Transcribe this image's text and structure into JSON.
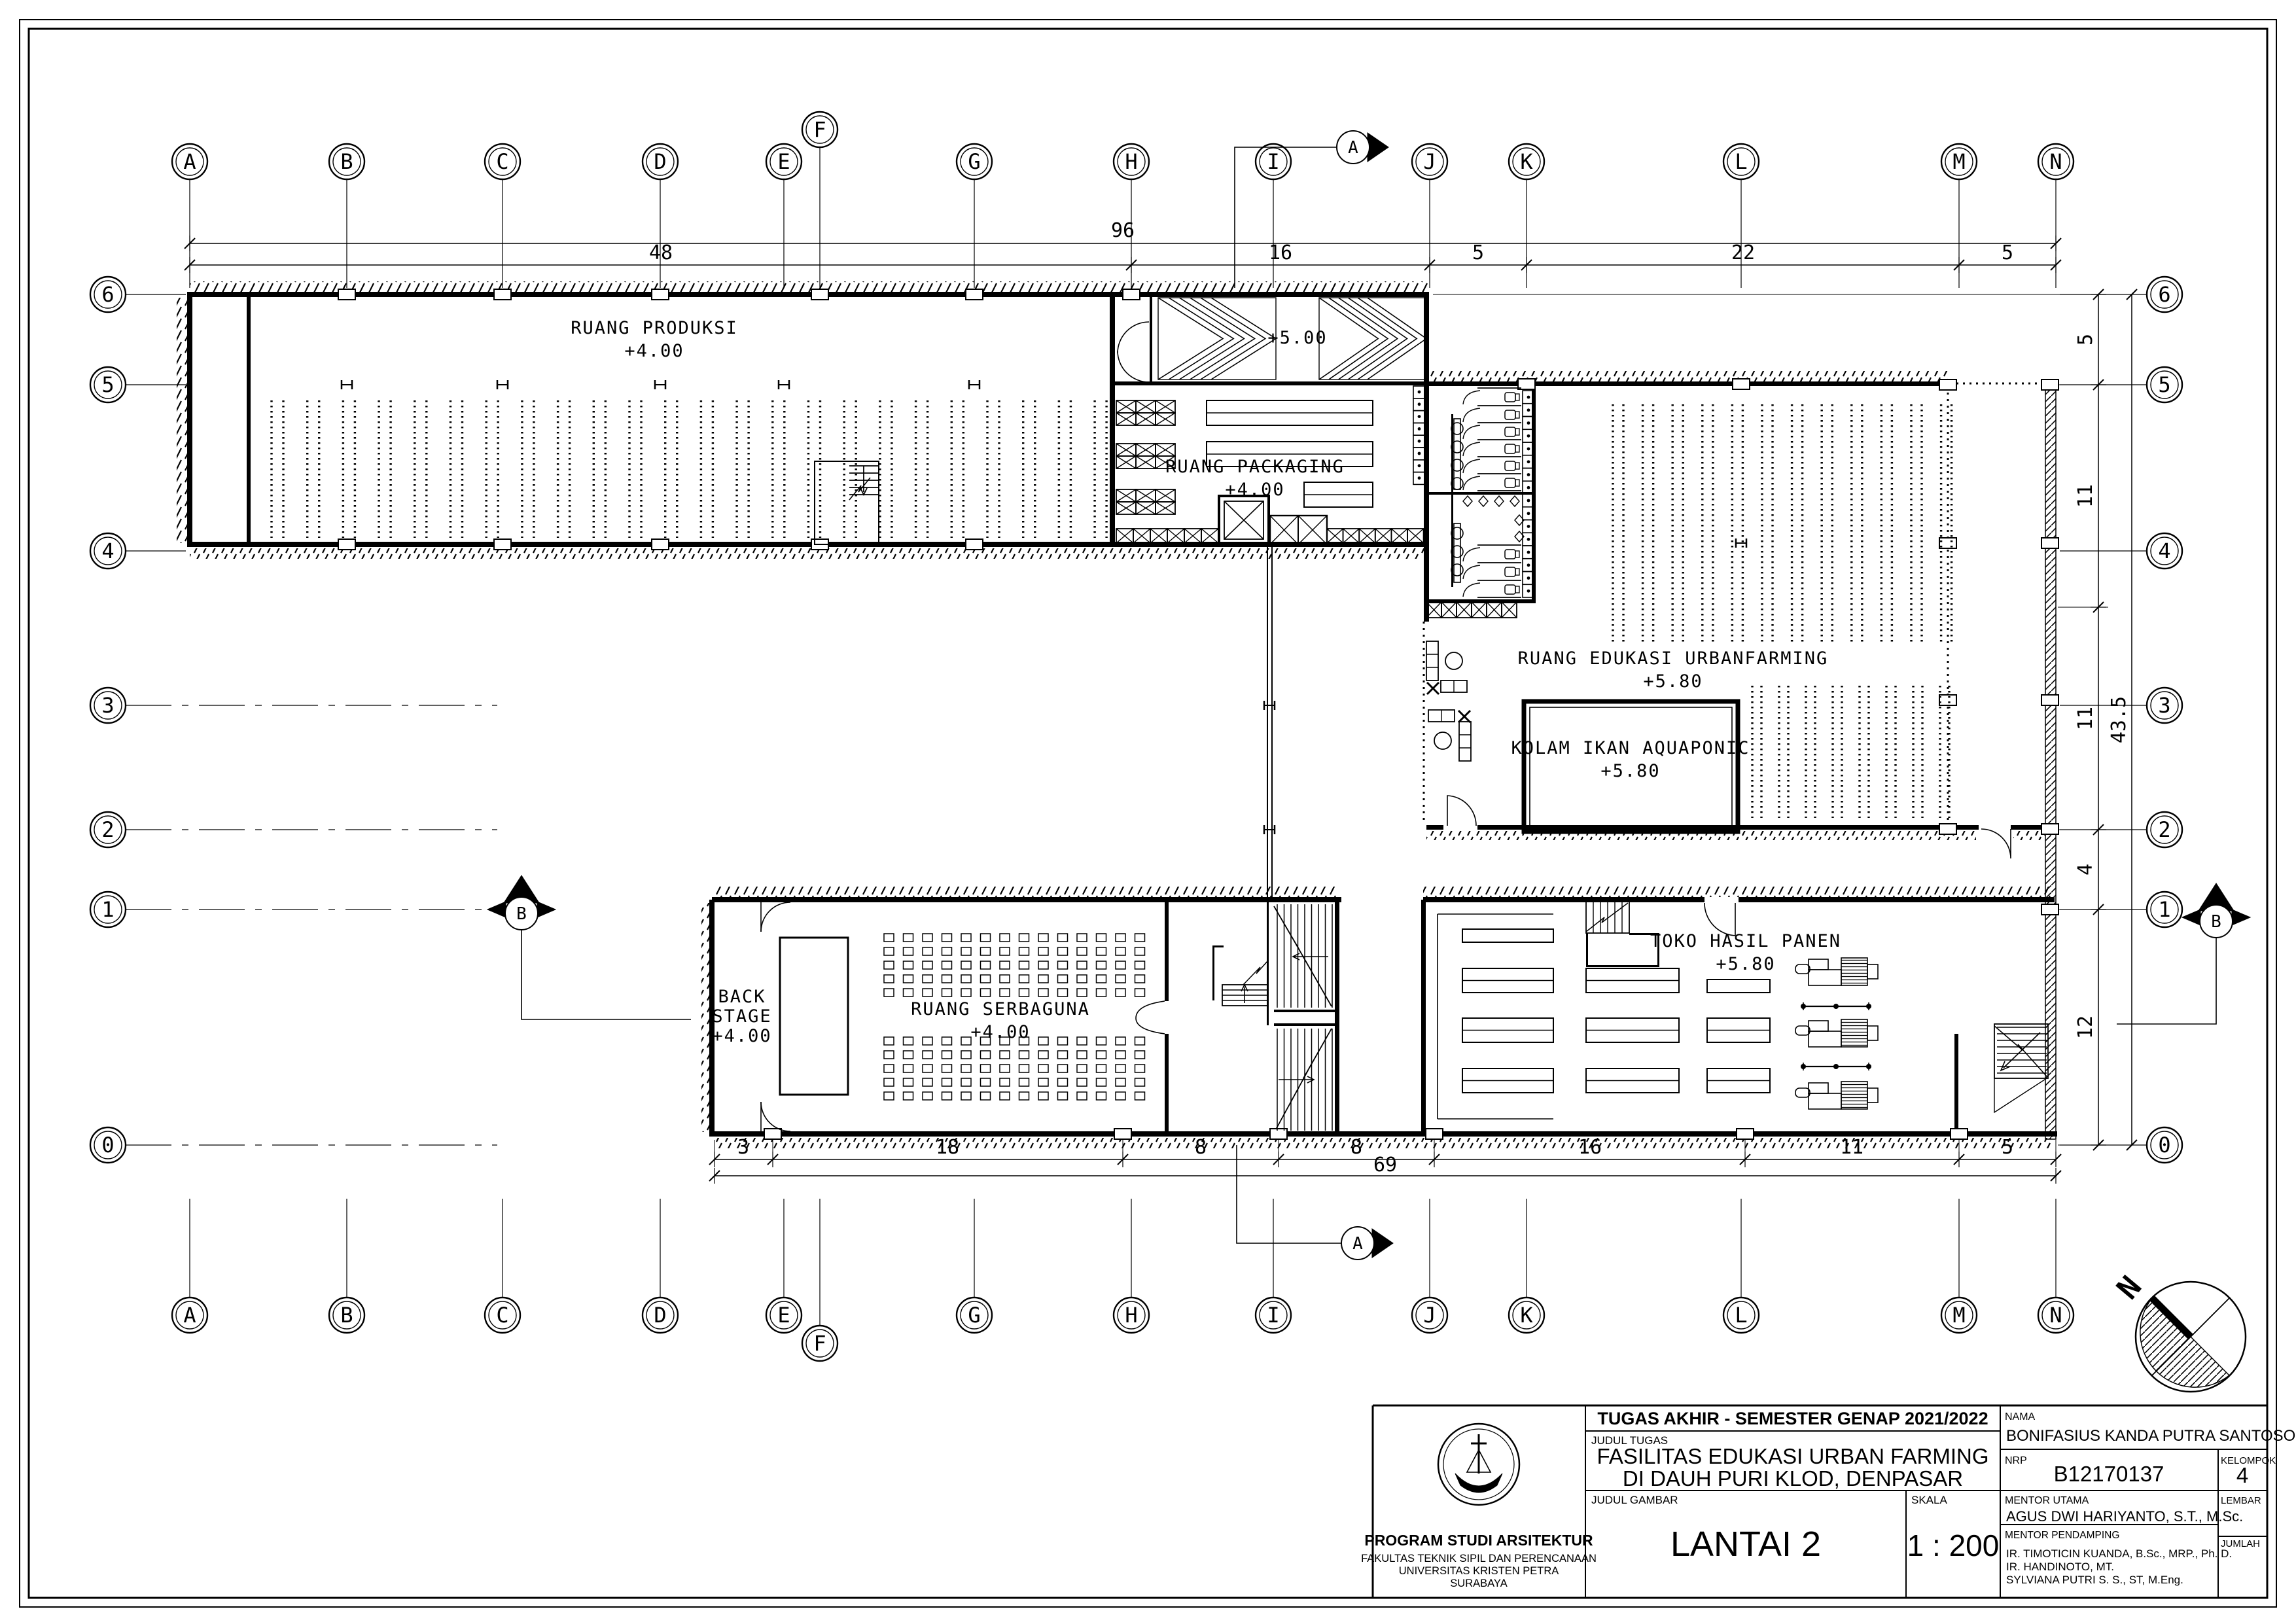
{
  "drawing": {
    "north_label": "N",
    "section_markers": {
      "a": "A",
      "b": "B"
    }
  },
  "grid": {
    "columns": [
      {
        "label": "A"
      },
      {
        "label": "B"
      },
      {
        "label": "C"
      },
      {
        "label": "D"
      },
      {
        "label": "E"
      },
      {
        "label": "F"
      },
      {
        "label": "G"
      },
      {
        "label": "H"
      },
      {
        "label": "I"
      },
      {
        "label": "J"
      },
      {
        "label": "K"
      },
      {
        "label": "L"
      },
      {
        "label": "M"
      },
      {
        "label": "N"
      }
    ],
    "rows": [
      {
        "label": "6"
      },
      {
        "label": "5"
      },
      {
        "label": "4"
      },
      {
        "label": "3"
      },
      {
        "label": "2"
      },
      {
        "label": "1"
      },
      {
        "label": "0"
      }
    ]
  },
  "dimensions": {
    "top_total": "96",
    "top_segments": [
      "48",
      "16",
      "5",
      "22",
      "5"
    ],
    "bottom_segments": [
      "3",
      "18",
      "8",
      "8",
      "16",
      "11",
      "5"
    ],
    "bottom_total": "69",
    "right_segments": [
      "5",
      "11",
      "11",
      "4",
      "12"
    ],
    "right_total": "43.5"
  },
  "rooms": {
    "produksi": {
      "name": "RUANG PRODUKSI",
      "level": "+4.00"
    },
    "packaging": {
      "name": "RUANG PACKAGING",
      "level": "+4.00"
    },
    "ramp": {
      "level": "+5.00"
    },
    "edukasi": {
      "name": "RUANG EDUKASI URBANFARMING",
      "level": "+5.80"
    },
    "kolam": {
      "name": "KOLAM IKAN AQUAPONIC",
      "level": "+5.80"
    },
    "toko": {
      "name": "TOKO HASIL PANEN",
      "level": "+5.80"
    },
    "serbaguna": {
      "name": "RUANG SERBAGUNA",
      "level": "+4.00"
    },
    "backstage": {
      "line1": "BACK",
      "line2": "STAGE",
      "level": "+4.00"
    }
  },
  "title_block": {
    "header": "TUGAS AKHIR - SEMESTER GENAP 2021/2022",
    "judul_tugas_label": "JUDUL TUGAS",
    "judul_tugas_line1": "FASILITAS EDUKASI URBAN FARMING",
    "judul_tugas_line2": "DI DAUH PURI KLOD, DENPASAR",
    "judul_gambar_label": "JUDUL GAMBAR",
    "judul_gambar": "LANTAI 2",
    "skala_label": "SKALA",
    "skala": "1 : 200",
    "nama_label": "NAMA",
    "nama": "BONIFASIUS KANDA PUTRA SANTOSO",
    "nrp_label": "NRP",
    "nrp": "B12170137",
    "kelompok_label": "KELOMPOK",
    "kelompok": "4",
    "mentor_utama_label": "MENTOR UTAMA",
    "mentor_utama": "AGUS DWI HARIYANTO, S.T., M.Sc.",
    "mentor_pendamping_label": "MENTOR PENDAMPING",
    "mentor_pendamping": [
      "IR. TIMOTICIN KUANDA, B.Sc., MRP., Ph. D.",
      "IR. HANDINOTO, MT.",
      "SYLVIANA PUTRI S. S., ST, M.Eng."
    ],
    "lembar_label": "LEMBAR",
    "jumlah_label": "JUMLAH",
    "program": "PROGRAM STUDI ARSITEKTUR",
    "fakultas": "FAKULTAS TEKNIK SIPIL DAN PERENCANAAN",
    "universitas": "UNIVERSITAS KRISTEN PETRA",
    "kota": "SURABAYA"
  }
}
